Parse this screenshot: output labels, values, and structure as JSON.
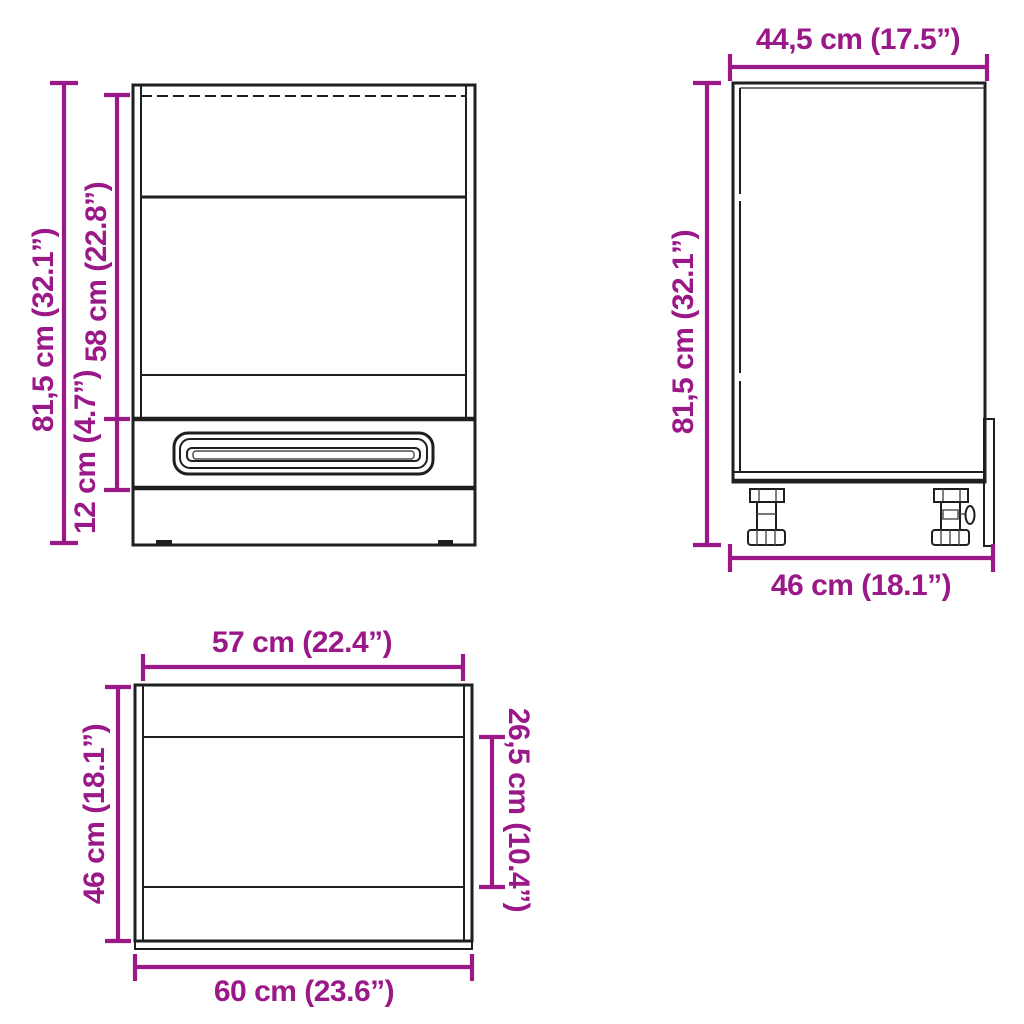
{
  "colors": {
    "accent": "#9B1889",
    "line": "#1f1f1f",
    "background": "#ffffff"
  },
  "diagram_title": "Oven cabinet dimension diagram",
  "front_view": {
    "height_label": "81,5 cm (32.1”)",
    "opening_label": "58 cm (22.8”)",
    "drawer_label": "12 cm (4.7”)"
  },
  "side_view": {
    "depth_top_label": "44,5 cm (17.5”)",
    "height_label": "81,5 cm (32.1”)",
    "depth_bottom_label": "46 cm (18.1”)"
  },
  "top_view": {
    "inner_width_label": "57 cm (22.4”)",
    "depth_label": "46 cm (18.1”)",
    "inner_depth_label": "26,5 cm (10.4”)",
    "outer_width_label": "60 cm (23.6”)"
  }
}
